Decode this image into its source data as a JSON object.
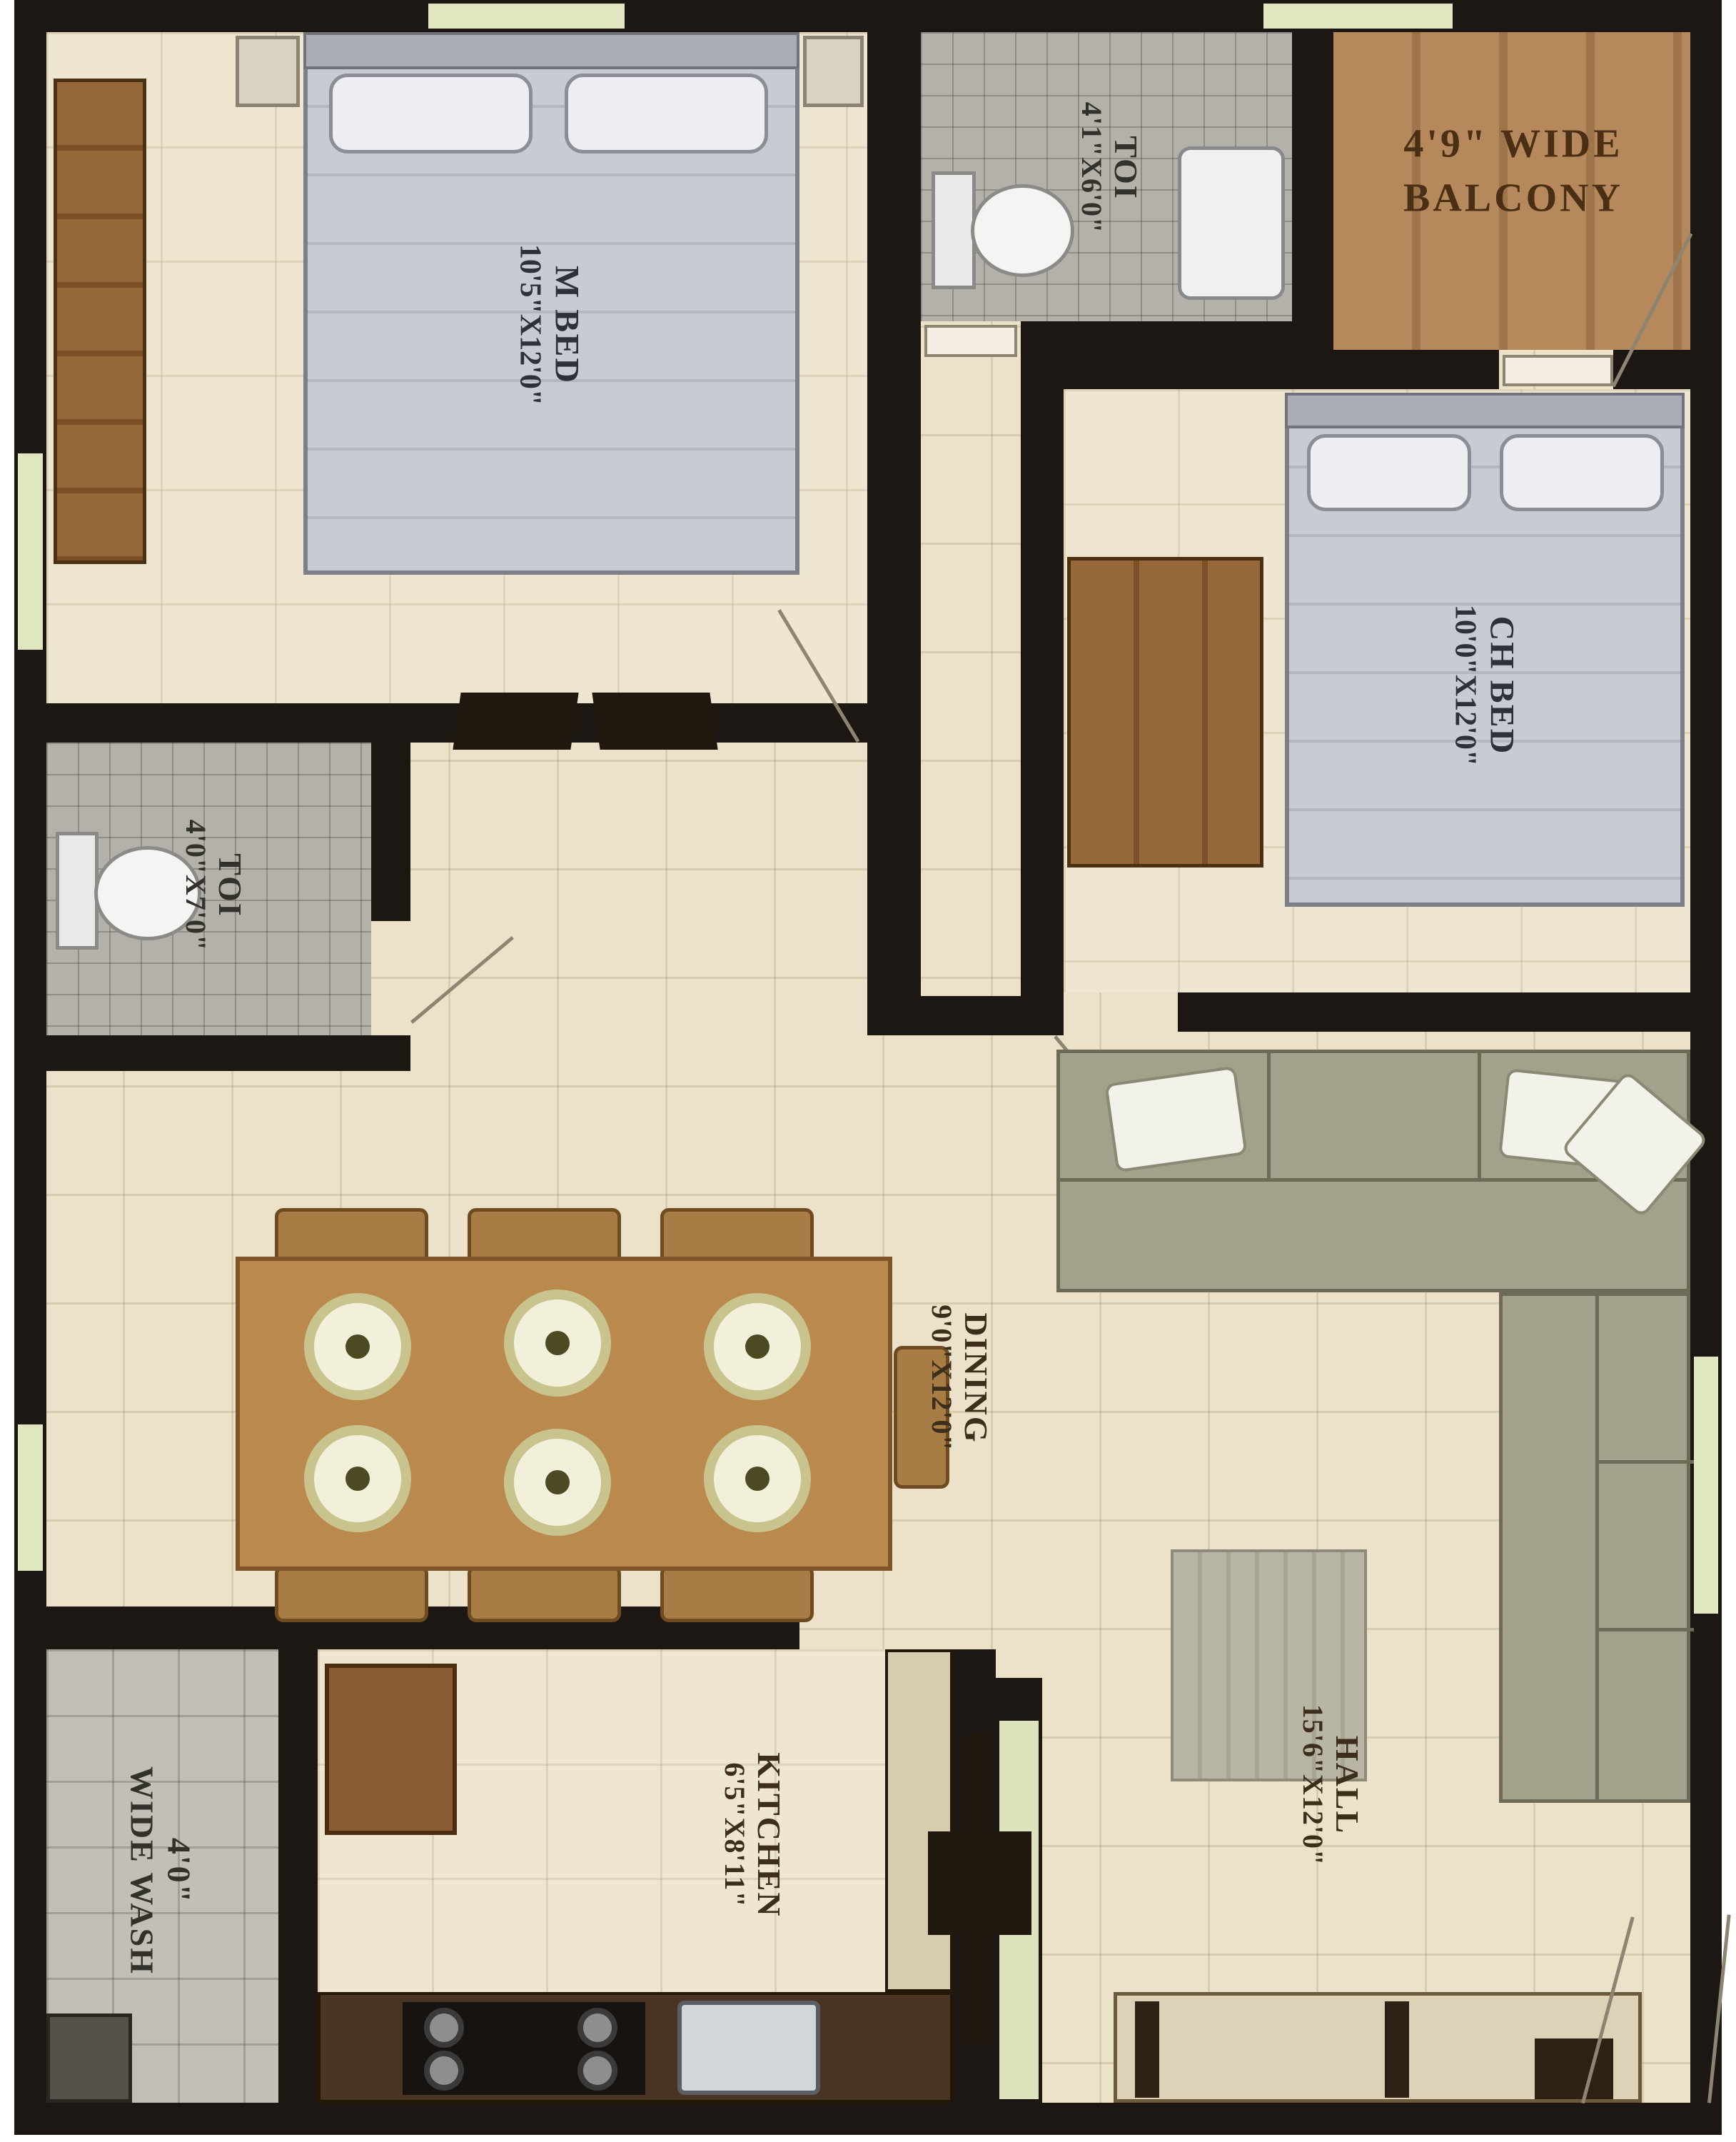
{
  "plan_title": "2BHK apartment floor plan",
  "rooms": {
    "m_bed": {
      "name": "M BED",
      "dims": "10'5\"X12'0\""
    },
    "toi_top": {
      "name": "TOI",
      "dims": "4'1\"X6'0\""
    },
    "balcony": {
      "line1": "4'9\" WIDE",
      "line2": "BALCONY"
    },
    "ch_bed": {
      "name": "CH BED",
      "dims": "10'0\"X12'0\""
    },
    "toi_left": {
      "name": "TOI",
      "dims": "4'0\"X7'0\""
    },
    "dining": {
      "name": "DINING",
      "dims": "9'0\"X12'0\""
    },
    "kitchen": {
      "name": "KITCHEN",
      "dims": "6'5\"X8'11\""
    },
    "hall": {
      "name": "HALL",
      "dims": "15'6\"X12'0\""
    },
    "wash": {
      "line1": "4'0\"",
      "line2": "WIDE WASH"
    }
  },
  "colors": {
    "wall": "#1c1712",
    "floor_beige": "#ece1c9",
    "tile_gray": "#b4b1aa",
    "balcony_wood": "#b5895c",
    "window_green": "#e0e6c0",
    "bed_gray": "#c8cbd2",
    "wardrobe_brown": "#96683a",
    "sofa_olive": "#a3a18c",
    "label_brown": "#3d2e1b"
  }
}
